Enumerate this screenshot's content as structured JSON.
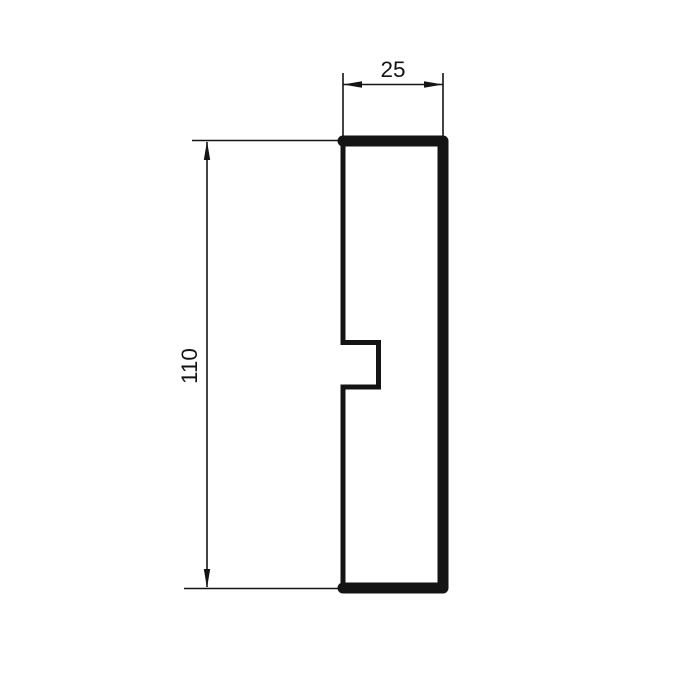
{
  "drawing": {
    "type": "technical-cross-section-profile",
    "background_color": "#ffffff",
    "line_color": "#141414",
    "dimensions": {
      "width_label": "25",
      "height_label": "110"
    }
  }
}
